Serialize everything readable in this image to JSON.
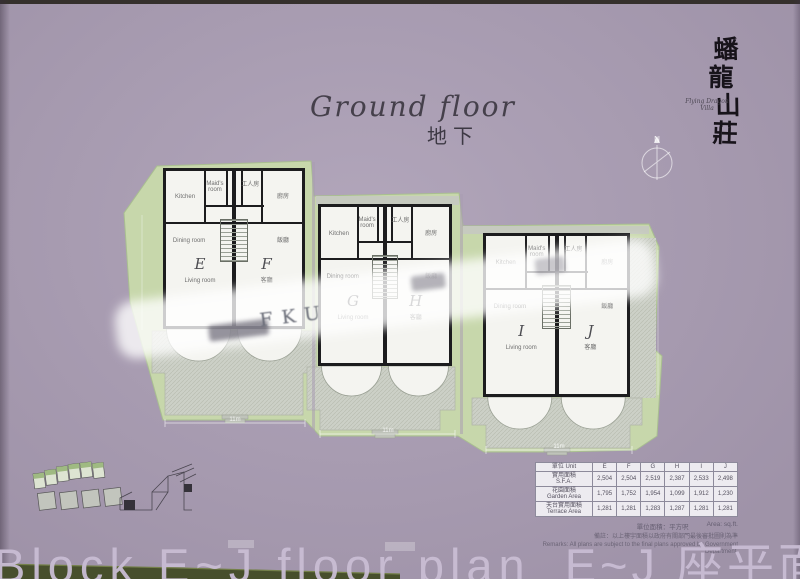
{
  "header": {
    "title_script": "Ground floor",
    "title_cjk": "地下"
  },
  "branding": {
    "calligraphy": [
      "蟠",
      "龍",
      "山",
      "莊"
    ],
    "subtitle_line1": "Flying Dragon",
    "subtitle_line2": "Villa"
  },
  "compass": {
    "label": "N"
  },
  "site": {
    "dim_labels": [
      "11m",
      "11m",
      "11m"
    ]
  },
  "buildings": [
    {
      "units": [
        {
          "letter": "E",
          "kitchen": "Kitchen",
          "maid": "Maid's room",
          "dining": "Dining room",
          "living": "Living room"
        },
        {
          "letter": "F",
          "maid": "工人房",
          "kitchen": "廚房",
          "dining": "飯廳",
          "living": "客廳"
        }
      ]
    },
    {
      "units": [
        {
          "letter": "G",
          "kitchen": "Kitchen",
          "maid": "Maid's room",
          "dining": "Dining room",
          "living": "Living room"
        },
        {
          "letter": "H",
          "maid": "工人房",
          "kitchen": "廚房",
          "dining": "飯廳",
          "living": "客廳"
        }
      ]
    },
    {
      "units": [
        {
          "letter": "I",
          "kitchen": "Kitchen",
          "maid": "Maid's room",
          "dining": "Dining room",
          "living": "Living room"
        },
        {
          "letter": "J",
          "maid": "工人房",
          "kitchen": "廚房",
          "dining": "飯廳",
          "living": "客廳"
        }
      ]
    }
  ],
  "watermark": {
    "latin": "FKU"
  },
  "area_table": {
    "header": {
      "zh": "單位",
      "en": "Unit"
    },
    "columns": [
      "E",
      "F",
      "G",
      "H",
      "I",
      "J"
    ],
    "rows": [
      {
        "label_zh": "實用面積",
        "label_en": "S.F.A.",
        "values": [
          "2,504",
          "2,504",
          "2,519",
          "2,387",
          "2,533",
          "2,498"
        ]
      },
      {
        "label_zh": "花園面積",
        "label_en": "Garden Area",
        "values": [
          "1,795",
          "1,752",
          "1,954",
          "1,099",
          "1,912",
          "1,230"
        ]
      },
      {
        "label_zh": "天台實用面積",
        "label_en": "Terrace Area",
        "values": [
          "1,281",
          "1,281",
          "1,283",
          "1,287",
          "1,281",
          "1,281"
        ]
      }
    ],
    "unit_note_zh": "單位面積：平方呎",
    "unit_note_en": "Area: sq.ft.",
    "remark_zh": "備註：以上樓宇面積以政府有關部門最後審批圖則為準",
    "remark_en": "Remarks: All plans are subject to the final plans approved by Government Department."
  },
  "footer": {
    "title_en": "Block E~J floor plan",
    "title_zh": "E~J 座平面圖"
  },
  "colors": {
    "page_bg": "#a99cb3",
    "site_green": "#c7d7ab",
    "patio_gray": "#ccd0c7",
    "wall": "#1c1c1e",
    "footer_text": "#c9bdd4"
  }
}
